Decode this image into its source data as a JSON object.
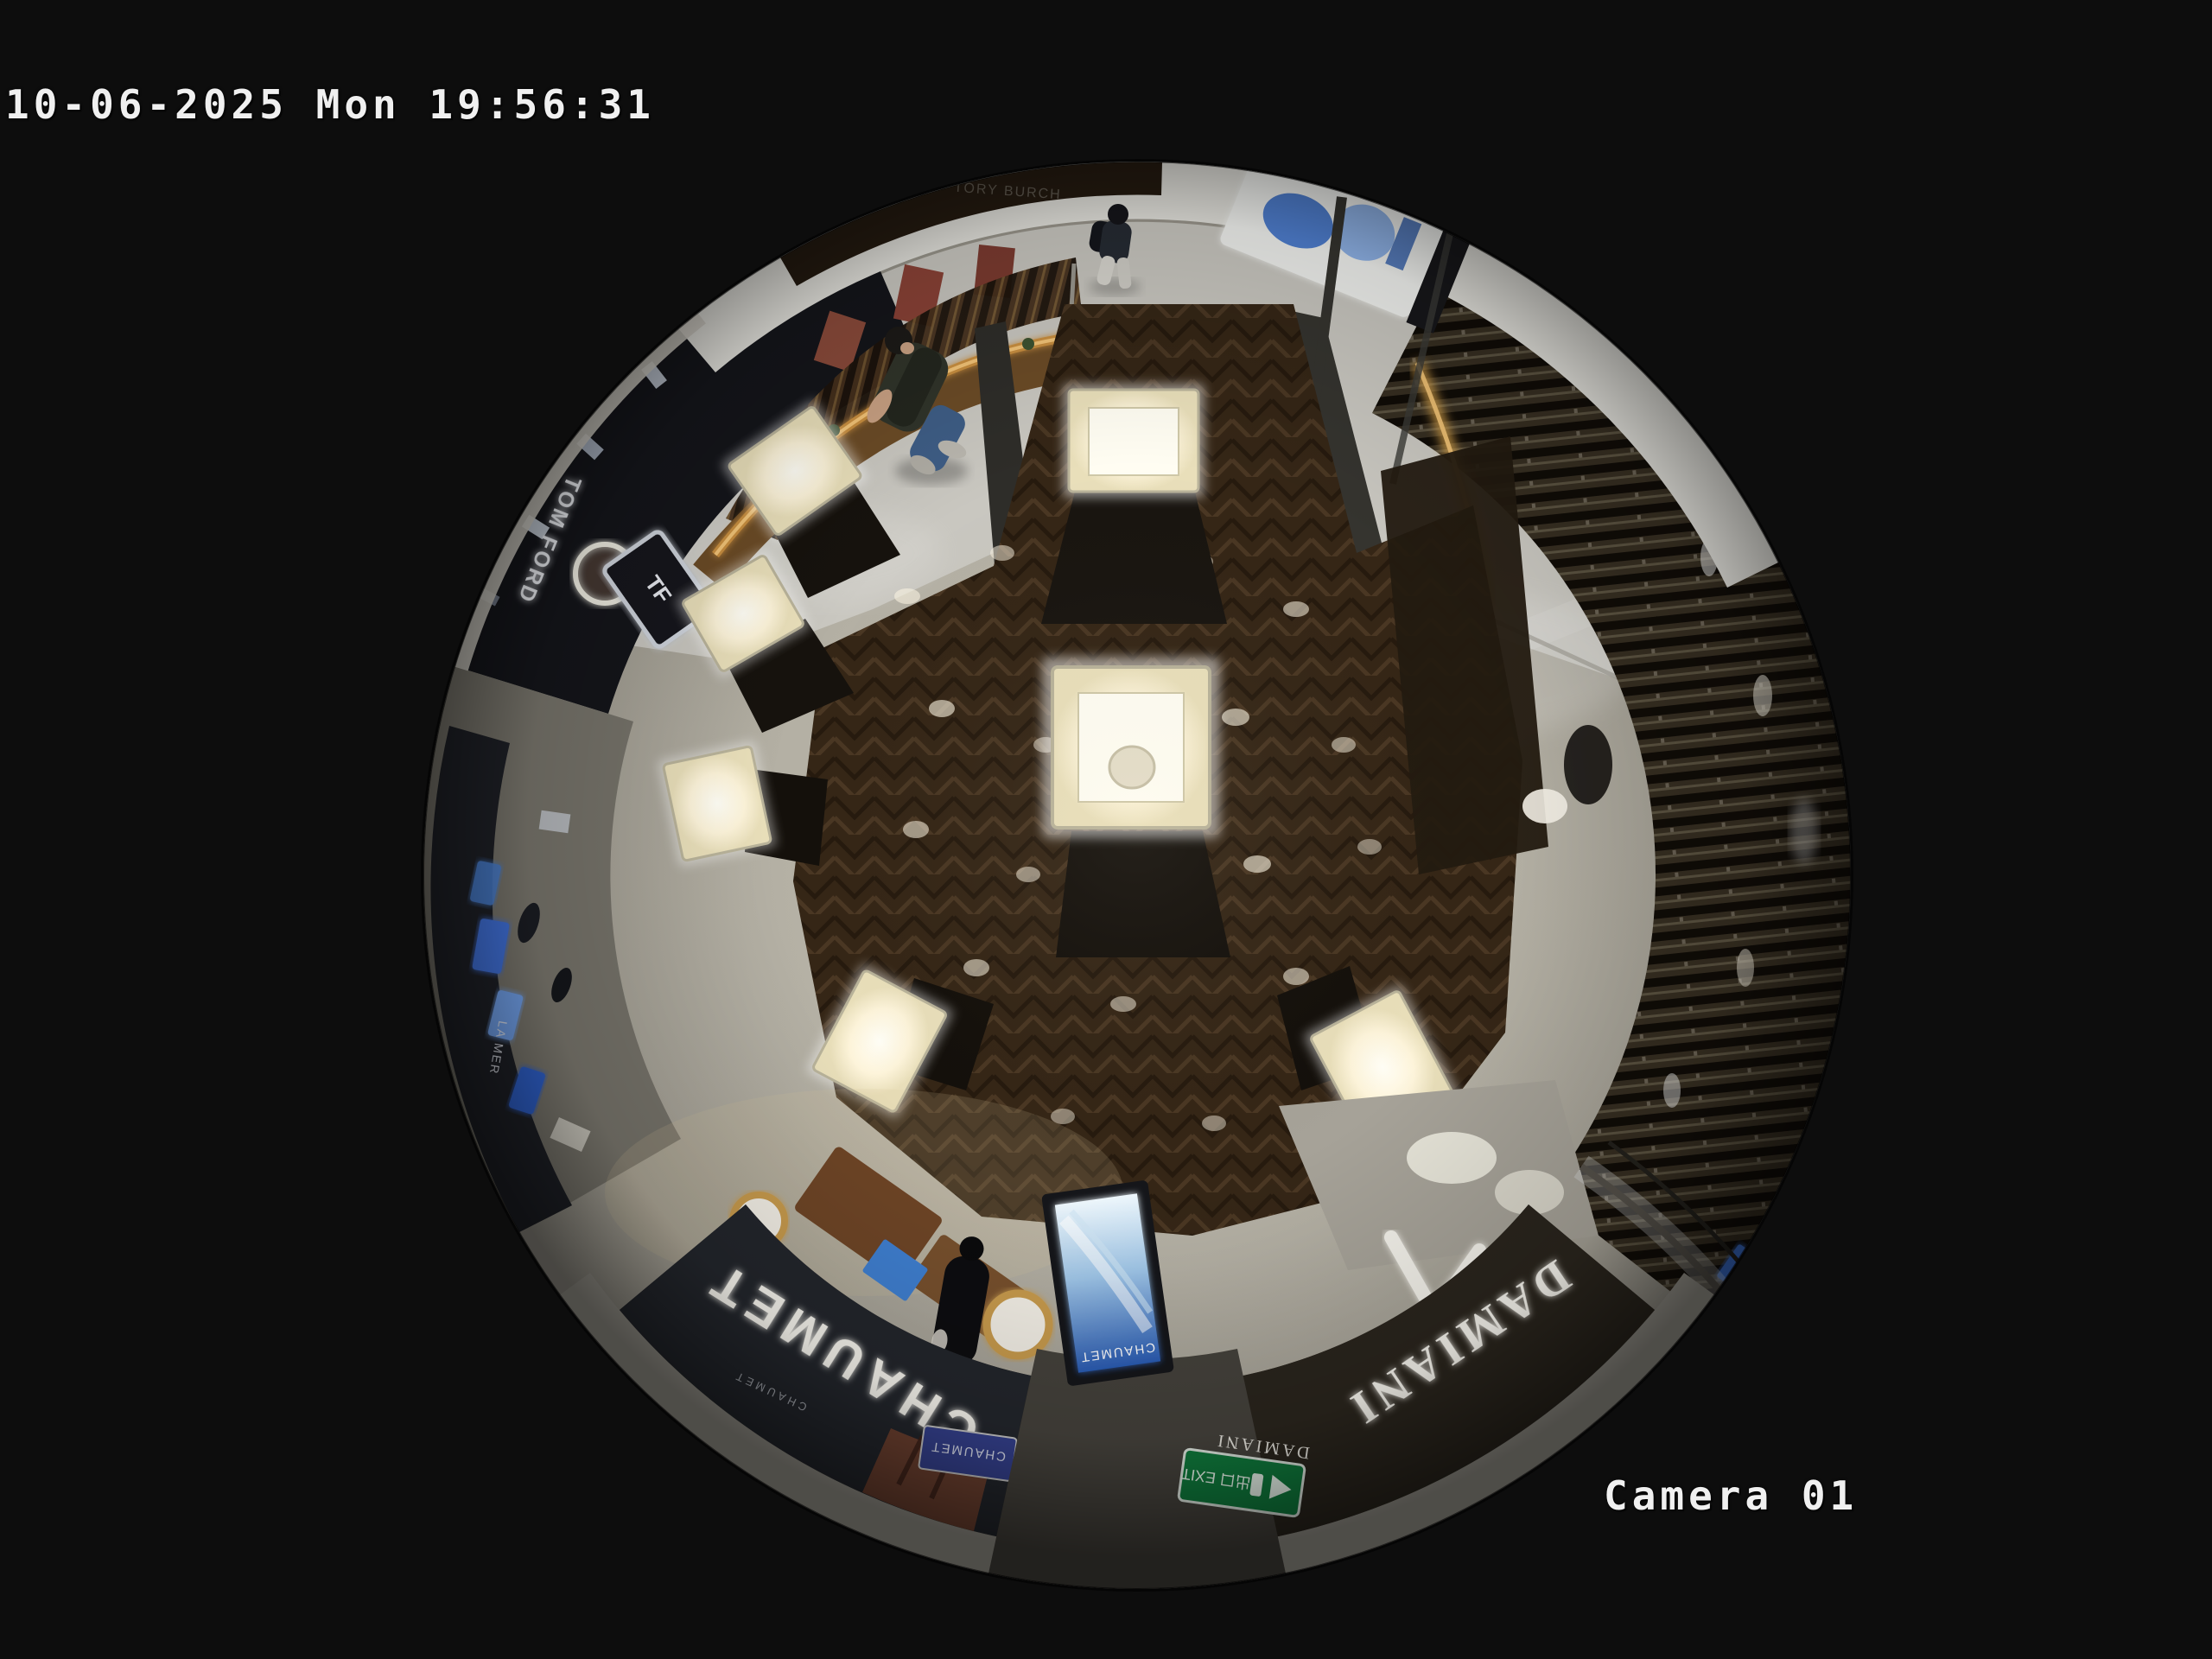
{
  "osd": {
    "timestamp": "10-06-2025 Mon 19:56:31",
    "camera_label": "Camera 01"
  },
  "signs": {
    "tom_ford": "TOM FORD",
    "tf_monogram": "TF",
    "tory_burch": "TORY BURCH",
    "chaumet_fascia": "CHAUMET",
    "chaumet_fascia_small": "CHAUMET",
    "chaumet_screen": "CHAUMET",
    "chaumet_directory": "CHAUMET",
    "damiani_fascia": "DAMIANI",
    "damiani_door": "DAMIANI",
    "la_mer": "LA MER",
    "exit_sign": "出口 EXIT"
  },
  "colors": {
    "background": "#0d0d0d",
    "osd_text": "#f0f0f0",
    "exit_green": "#0f7a3c",
    "screen_blue": "#2a5cb4",
    "accent_amber": "#d9a44c",
    "wood_floor": "#3e2c1b",
    "stone_floor": "#b3afa3"
  }
}
